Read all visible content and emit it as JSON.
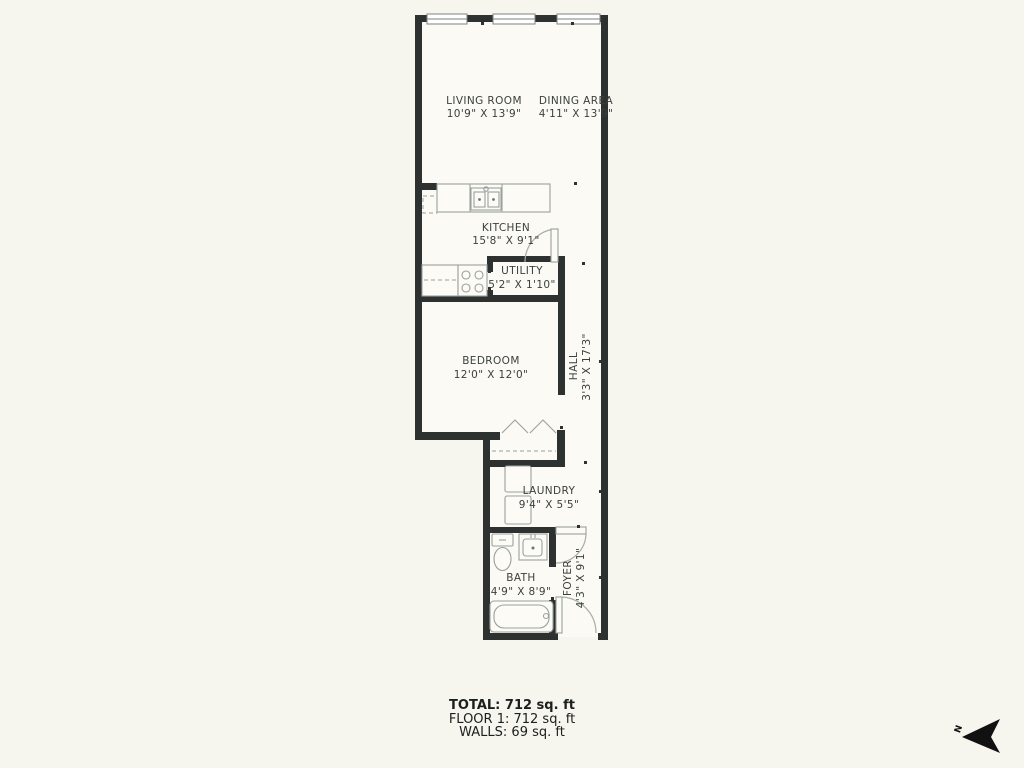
{
  "background_color": "#f6f5ee",
  "plan": {
    "wall_color": "#2d3230",
    "interior_color": "#fbfaf4",
    "fixture_line_color": "#9aa19d",
    "label_color": "#3b403e",
    "rooms": {
      "living_room": {
        "name": "LIVING ROOM",
        "dims": "10'9\" X 13'9\""
      },
      "dining_area": {
        "name": "DINING AREA",
        "dims": "4'11\" X 13'9\""
      },
      "kitchen": {
        "name": "KITCHEN",
        "dims": "15'8\" X 9'1\""
      },
      "utility": {
        "name": "UTILITY",
        "dims": "5'2\" X 1'10\""
      },
      "bedroom": {
        "name": "BEDROOM",
        "dims": "12'0\" X 12'0\""
      },
      "hall": {
        "name": "HALL",
        "dims": "3'3\" X 17'3\""
      },
      "laundry": {
        "name": "LAUNDRY",
        "dims": "9'4\" X 5'5\""
      },
      "bath": {
        "name": "BATH",
        "dims": "4'9\" X 8'9\""
      },
      "foyer": {
        "name": "FOYER",
        "dims": "4'3\" X 9'1\""
      }
    }
  },
  "summary": {
    "total": "TOTAL: 712 sq. ft",
    "floor": "FLOOR 1: 712 sq. ft",
    "walls": "WALLS: 69 sq. ft"
  },
  "compass": {
    "label": "N"
  }
}
